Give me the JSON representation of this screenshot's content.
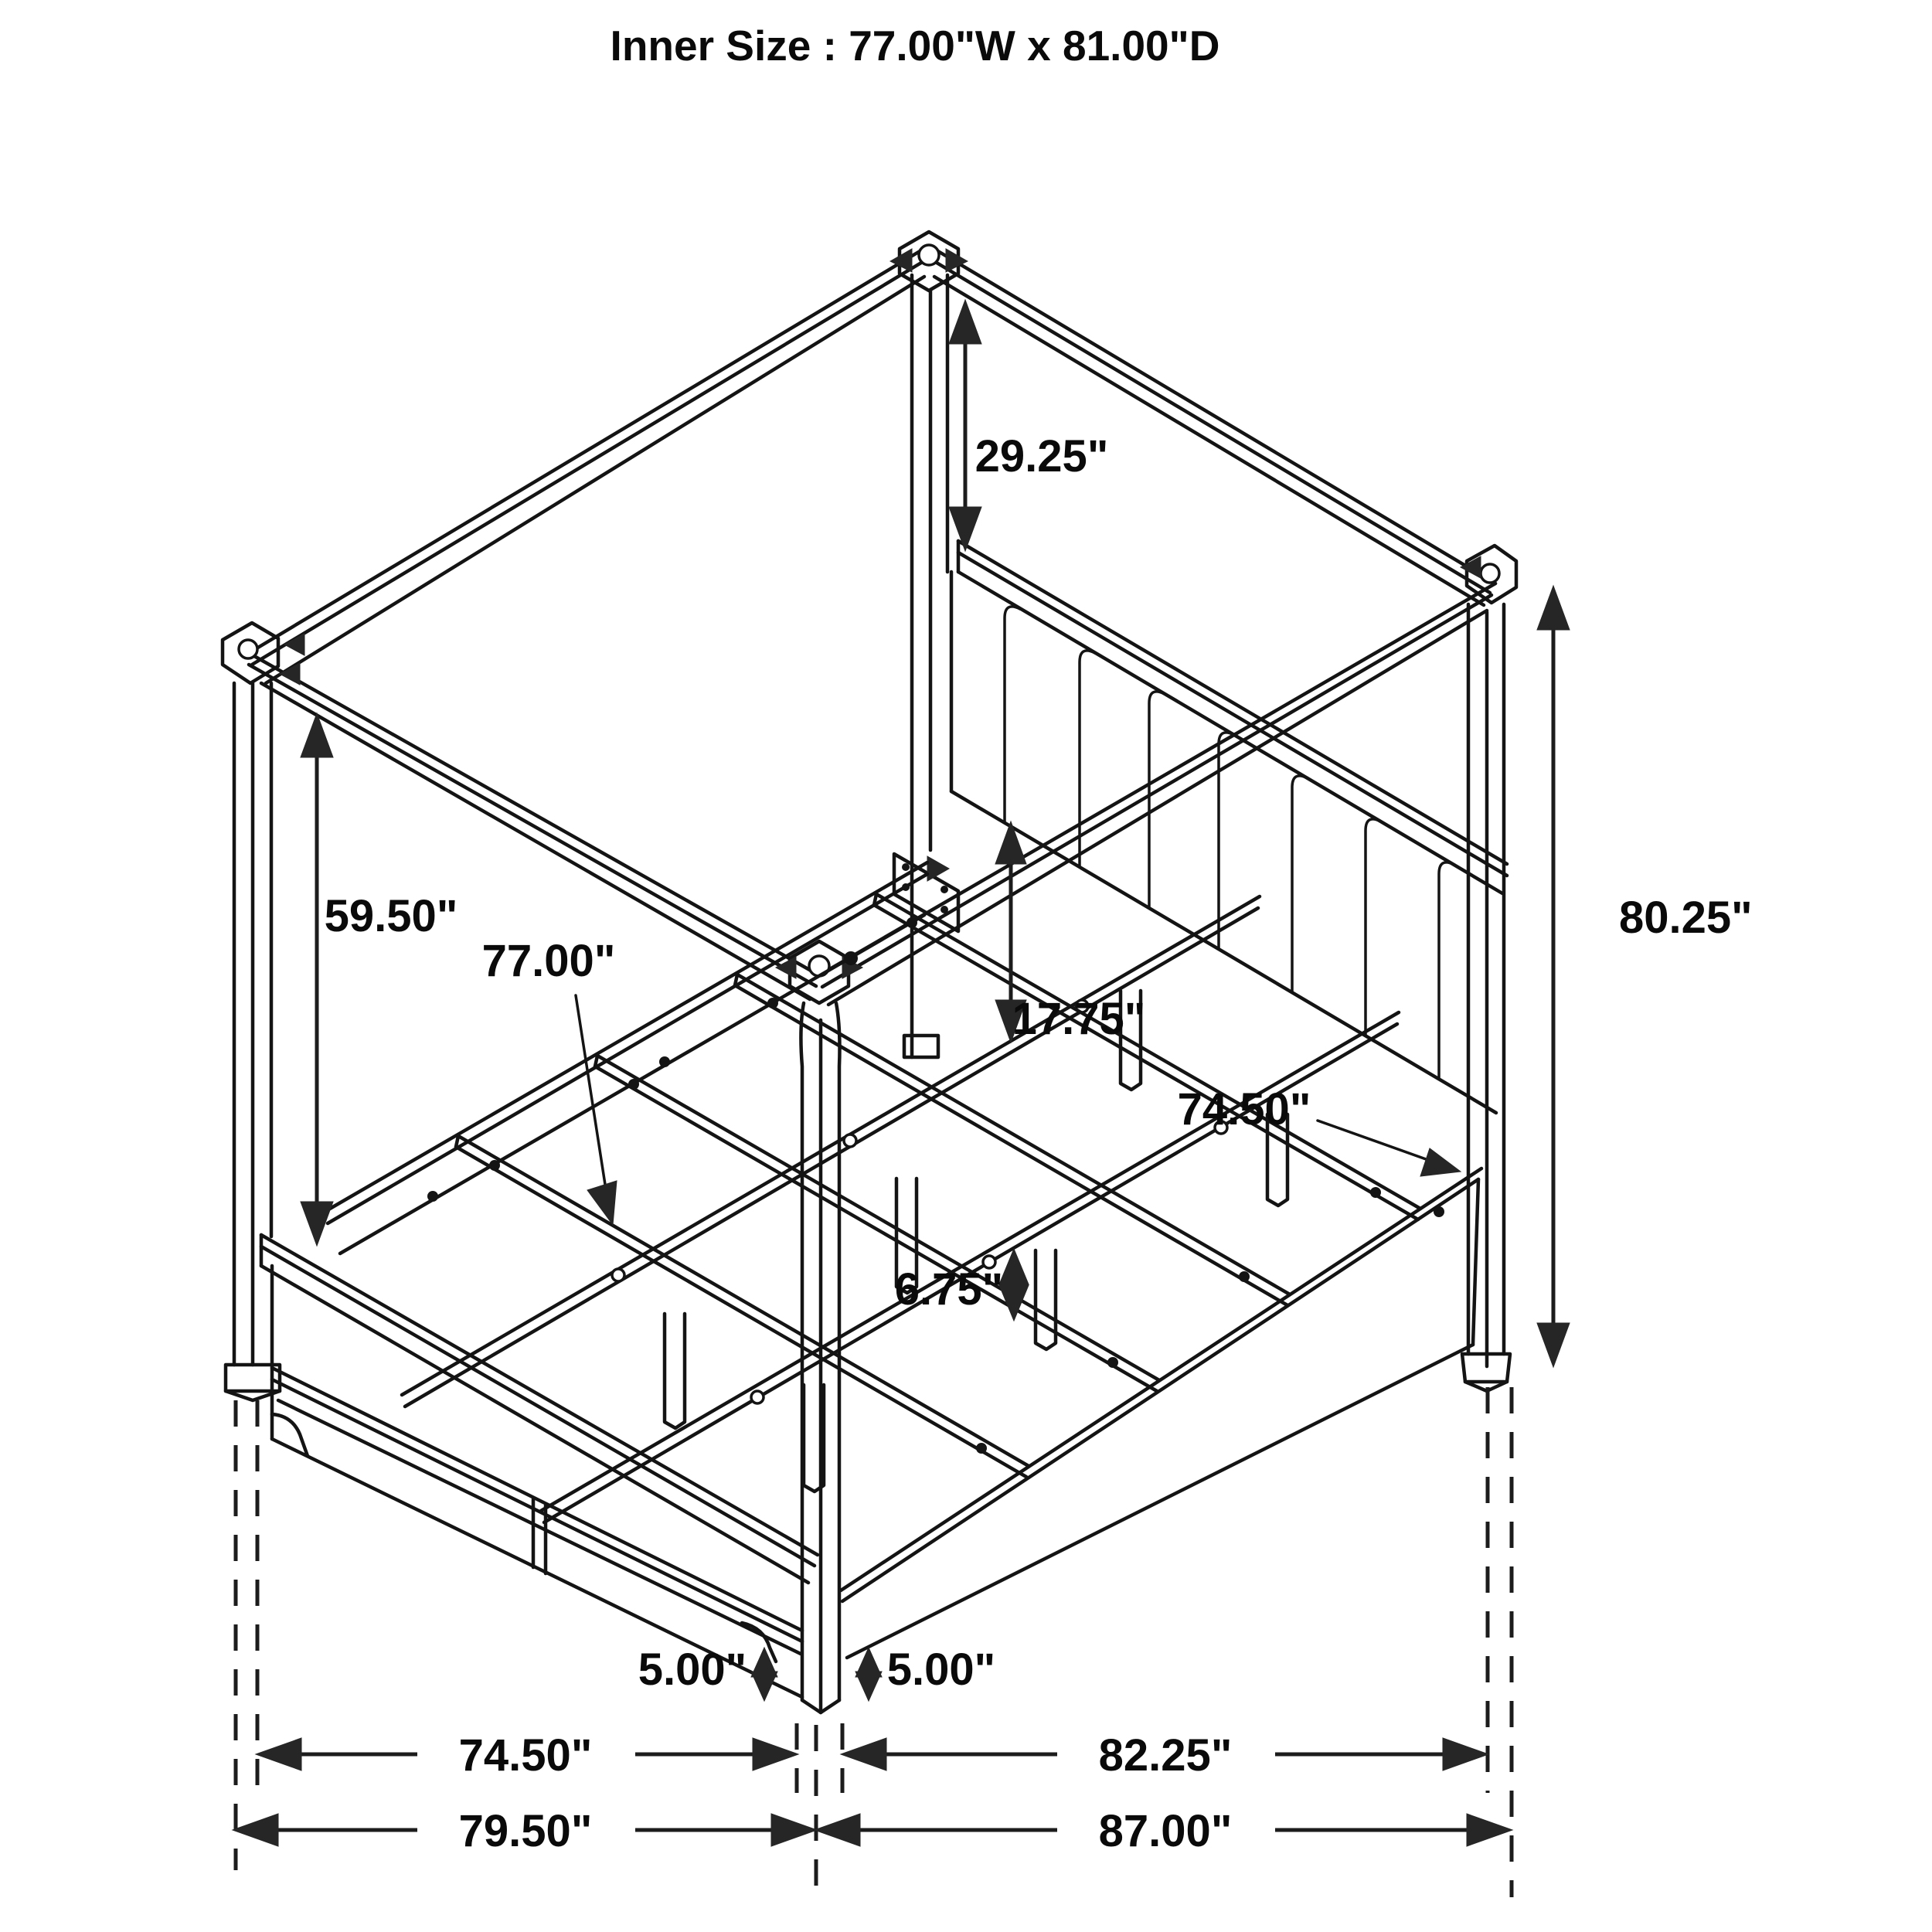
{
  "title": "Inner Size : 77.00\"W x 81.00\"D",
  "dimensions": {
    "headboard_post_top": "29.25\"",
    "canopy_underside": "59.50\"",
    "slat_width": "77.00\"",
    "platform_height": "17.75\"",
    "side_rail_length": "74.50\"",
    "overall_height": "80.25\"",
    "support_leg_height": "6.75\"",
    "footboard_floor_gap": "5.00\"",
    "siderail_floor_gap": "5.00\"",
    "footboard_span": "74.50\"",
    "siderail_span": "82.25\"",
    "overall_width": "79.50\"",
    "overall_depth": "87.00\""
  }
}
